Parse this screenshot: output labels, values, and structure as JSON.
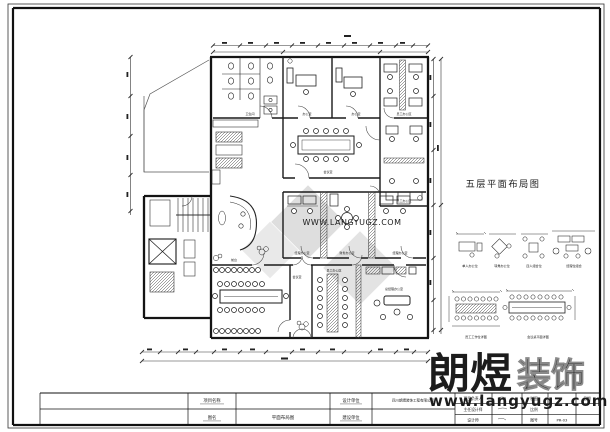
{
  "plan": {
    "title": "五层平面布局图"
  },
  "rooms": {
    "toilet": "卫生间",
    "office_a": "办公室",
    "office_b": "办公室",
    "ws_top": "员工办公区",
    "meeting_center": "会议室",
    "ws_right": "员工办公区",
    "manager_1": "经理办公室",
    "finance": "财务办公室",
    "manager_2": "经理办公室",
    "meeting_large": "会议室",
    "ws_bottom": "员工办公区",
    "gm_office": "总经理办公室",
    "reception": "前台"
  },
  "legend": {
    "item_1": "单人办公位",
    "item_2": "转角办公位",
    "item_3": "四人组合位",
    "item_4": "经理位组合",
    "detail_left": "员工工作位详图",
    "detail_right": "会议桌平面详图"
  },
  "title_block": {
    "project_name_label": "项目名称",
    "drawing_name_label": "图名",
    "drawing_name_value": "平面布局图",
    "design_unit_label": "设计单位",
    "design_unit_value": "四川朗煜装饰工程有限公司",
    "construction_unit_label": "建设单位",
    "project_lead_label": "项目负责人",
    "chief_designer_label": "主任设计师",
    "designer_label": "设计师",
    "draft_label": "制图",
    "scale_label": "比例",
    "sheet_no_label": "图号",
    "date_label": "日期",
    "sheet_no_value": "PR-03"
  },
  "watermark": {
    "brand_bold": "朗煜",
    "brand_light": "装饰",
    "url": "www.langyugz.com",
    "faint": "WWW.LANGYUGZ.COM"
  }
}
